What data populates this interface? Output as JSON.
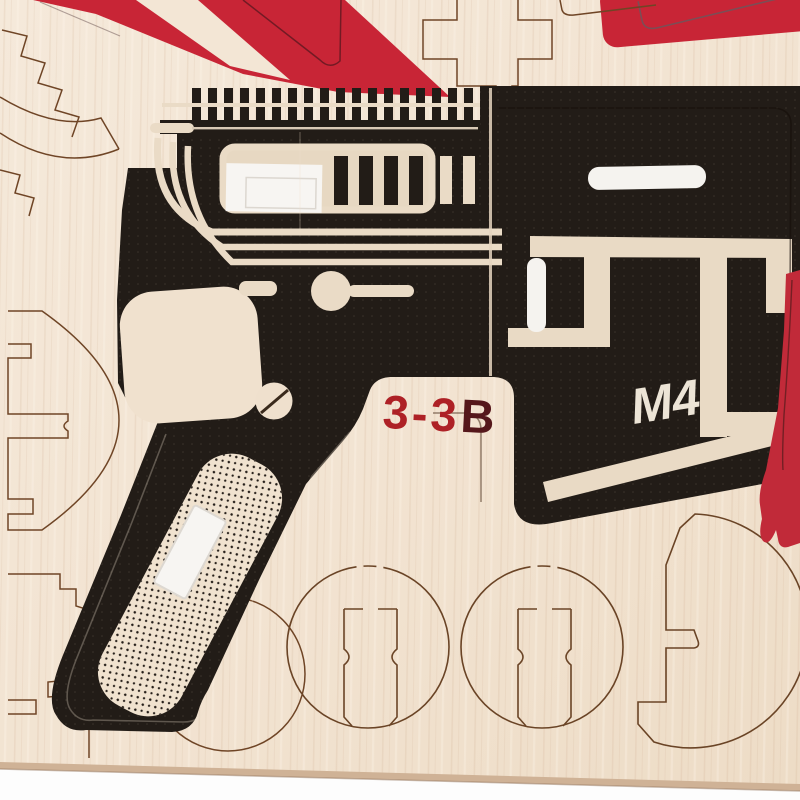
{
  "photo": {
    "subject": "Laser-cut plywood 3D-puzzle model sheet with black-printed M4 rifle parts, red painted star fragments and round gear pieces",
    "kit_markings": {
      "part_code": "3-3B",
      "part_code_prefix": "3-3",
      "part_code_suffix": "B",
      "model_mark": "M4"
    },
    "palette": {
      "wood_base": "#f3e6d6",
      "wood_mid": "#eeddc8",
      "print_black": "#221c17",
      "print_relief_wood": "#eadbc6",
      "paint_red": "#c82536",
      "paint_red_strip": "#c12a39",
      "sticker_white": "#f7f5f2",
      "cut_line_brown": "#6f4526",
      "board_edge_tan": "#cfb296",
      "backdrop_white": "#fdfdfd",
      "code_red": "#ae2126",
      "code_dark_red": "#55171b",
      "mark_white": "#ece4d6"
    },
    "pieces": [
      "m4-receiver-panel",
      "picatinny-rail-teeth",
      "ejection-port-frame",
      "pistol-grip",
      "grip-stipple-panel",
      "trigger-guard-opening",
      "screw-head-piece",
      "stock-section",
      "round-gear-piece-left",
      "round-gear-piece-right",
      "c-ring-piece-bottom-right",
      "half-disc-piece-left-edge",
      "stepped-arc-piece-top-left",
      "cross-connector-cutout",
      "red-star-fragment",
      "red-bar-piece-top-right",
      "red-strip-right-edge",
      "white-sticker-port",
      "white-sticker-grip"
    ]
  }
}
